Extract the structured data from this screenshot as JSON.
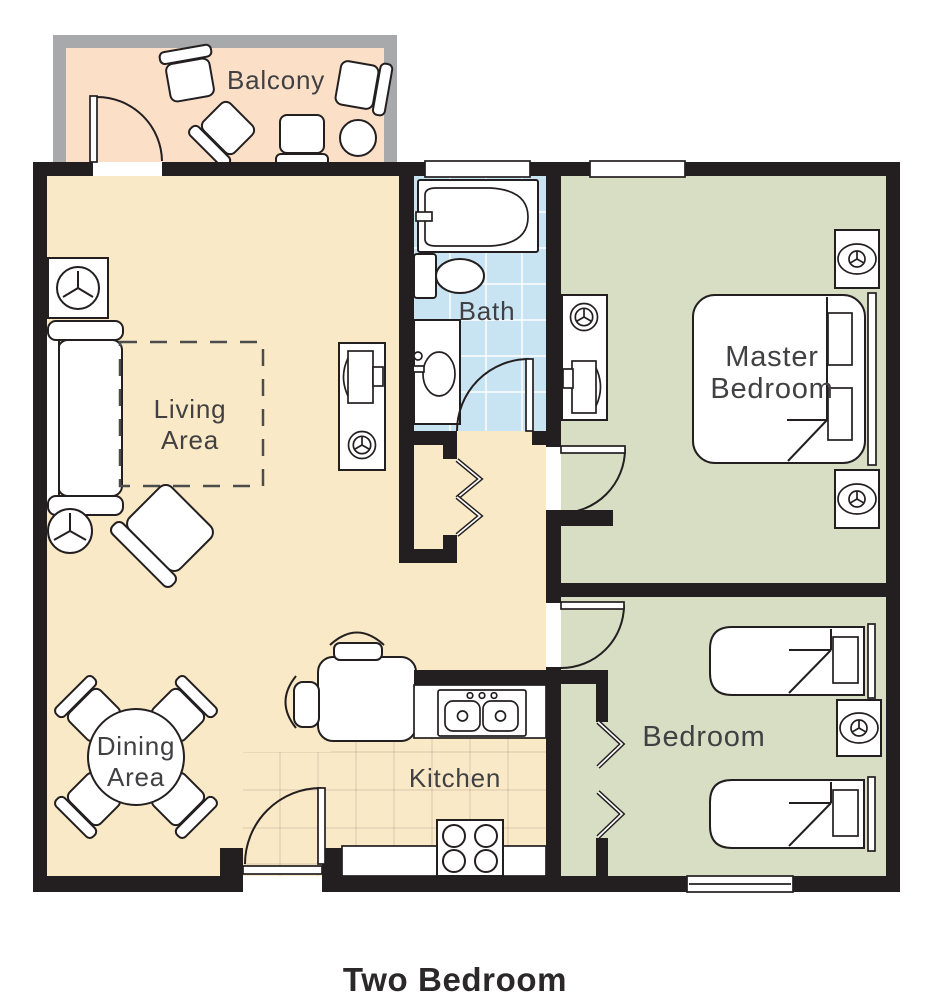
{
  "title": "Two Bedroom",
  "colors": {
    "wall": "#231F20",
    "living_floor": "#FAE9C6",
    "bedroom_floor": "#D7DEC3",
    "bath_floor": "#C8E4F3",
    "balcony_floor": "#FBDFC7",
    "balcony_wall": "#A7A9AB",
    "label_text": "#414042",
    "title_text": "#2B2829"
  },
  "icons": {
    "light_fixture": "circle-with-three-spoke-y-symbol"
  },
  "rooms": {
    "balcony": {
      "label": "Balcony"
    },
    "living": {
      "line1": "Living",
      "line2": "Area"
    },
    "bath": {
      "label": "Bath"
    },
    "master": {
      "line1": "Master",
      "line2": "Bedroom"
    },
    "bedroom": {
      "label": "Bedroom"
    },
    "dining": {
      "line1": "Dining",
      "line2": "Area"
    },
    "kitchen": {
      "label": "Kitchen"
    }
  }
}
